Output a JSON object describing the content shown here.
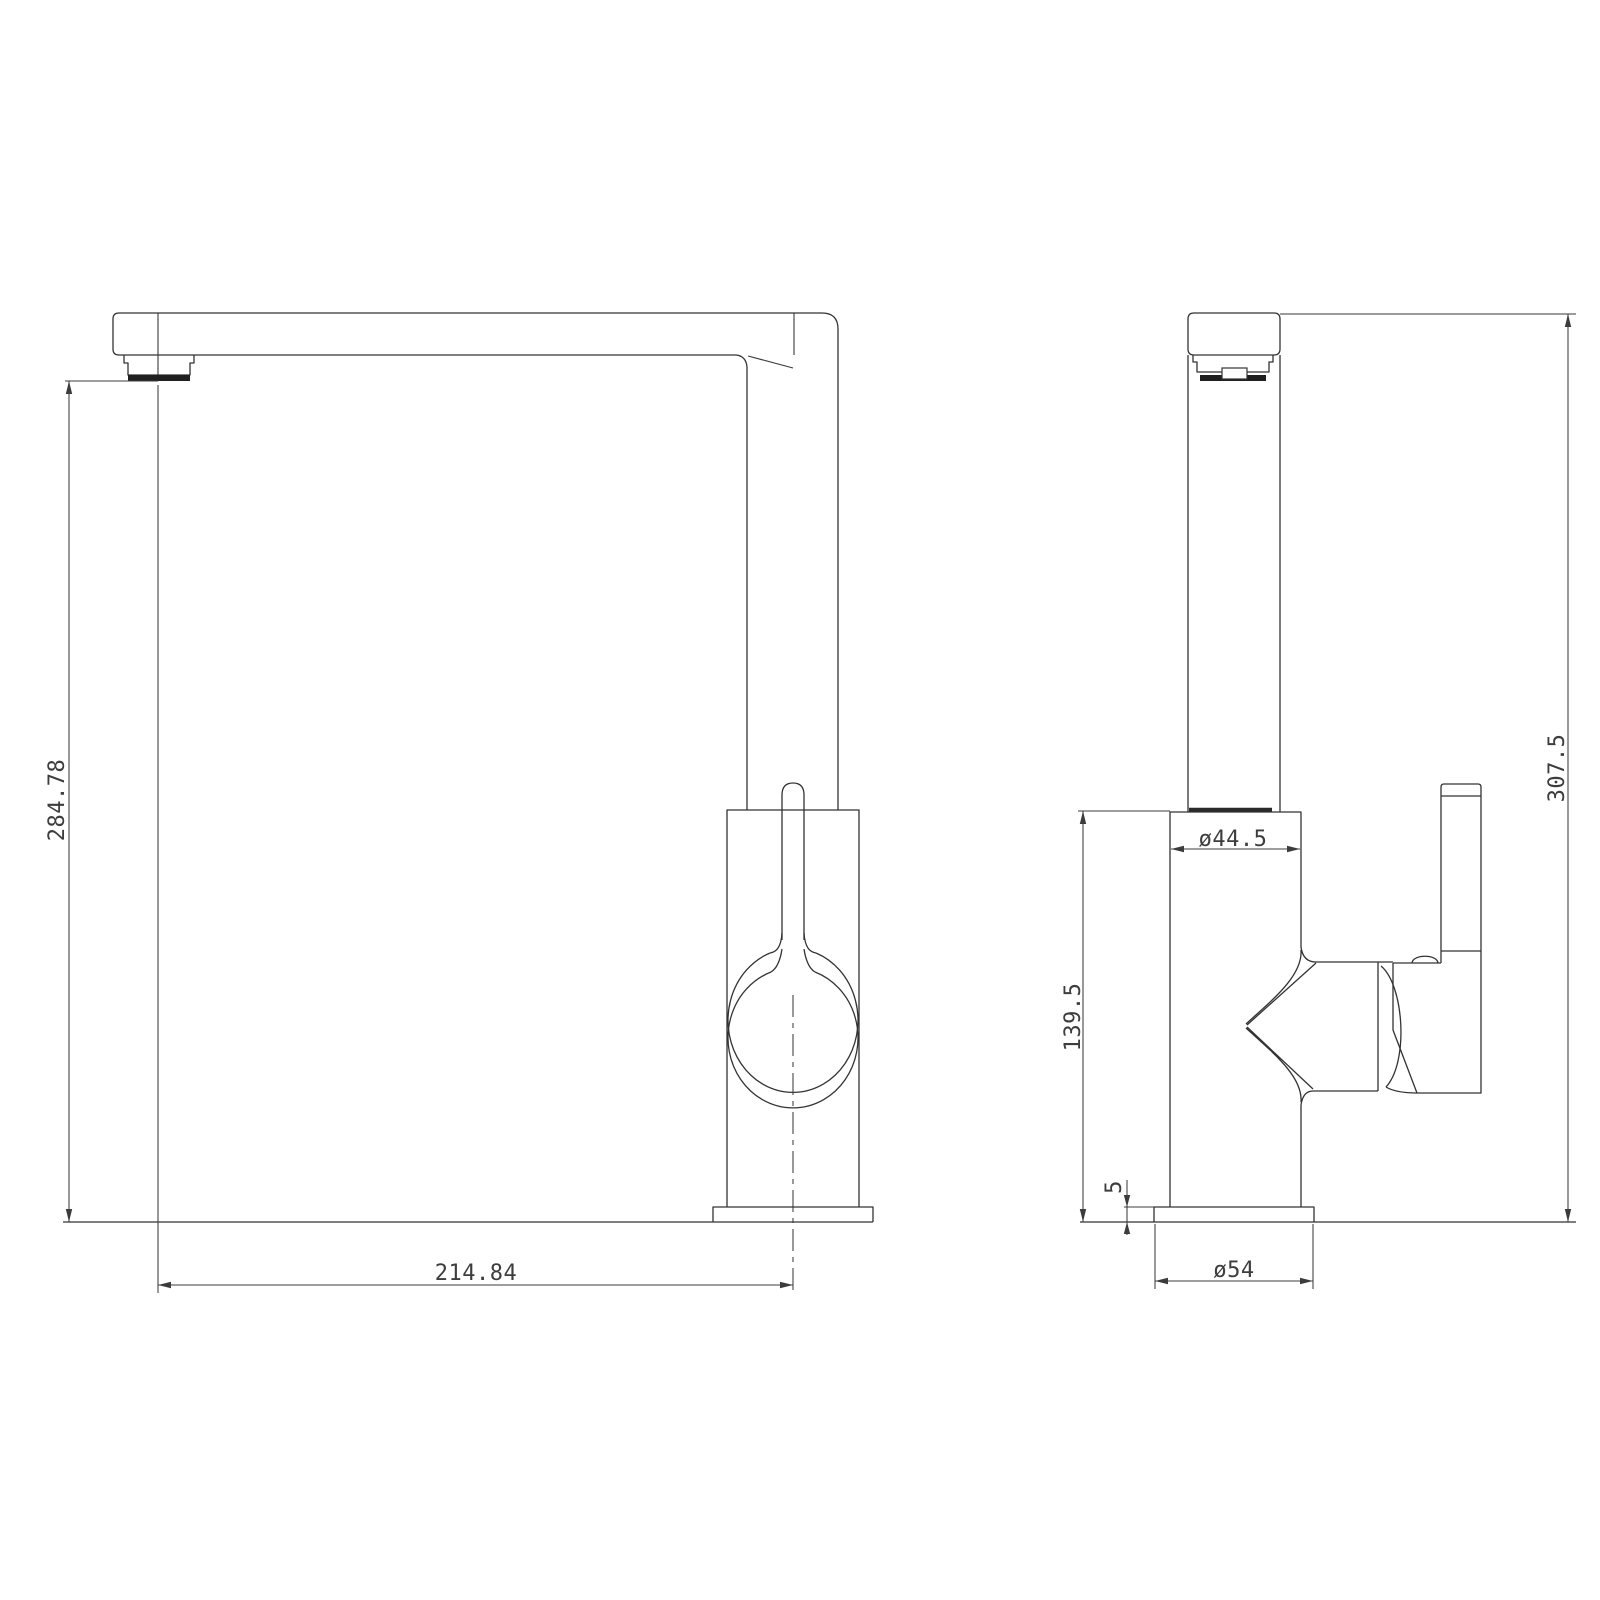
{
  "drawing": {
    "front_view": {
      "dim_height": "284.78",
      "dim_reach": "214.84"
    },
    "side_view": {
      "dim_body_diameter": "ø44.5",
      "dim_body_height": "139.5",
      "dim_base_thickness": "5",
      "dim_base_diameter": "ø54",
      "dim_total_height": "307.5"
    },
    "colors": {
      "line": "#333333",
      "dimension": "#3c3c3c",
      "background": "#ffffff"
    }
  }
}
